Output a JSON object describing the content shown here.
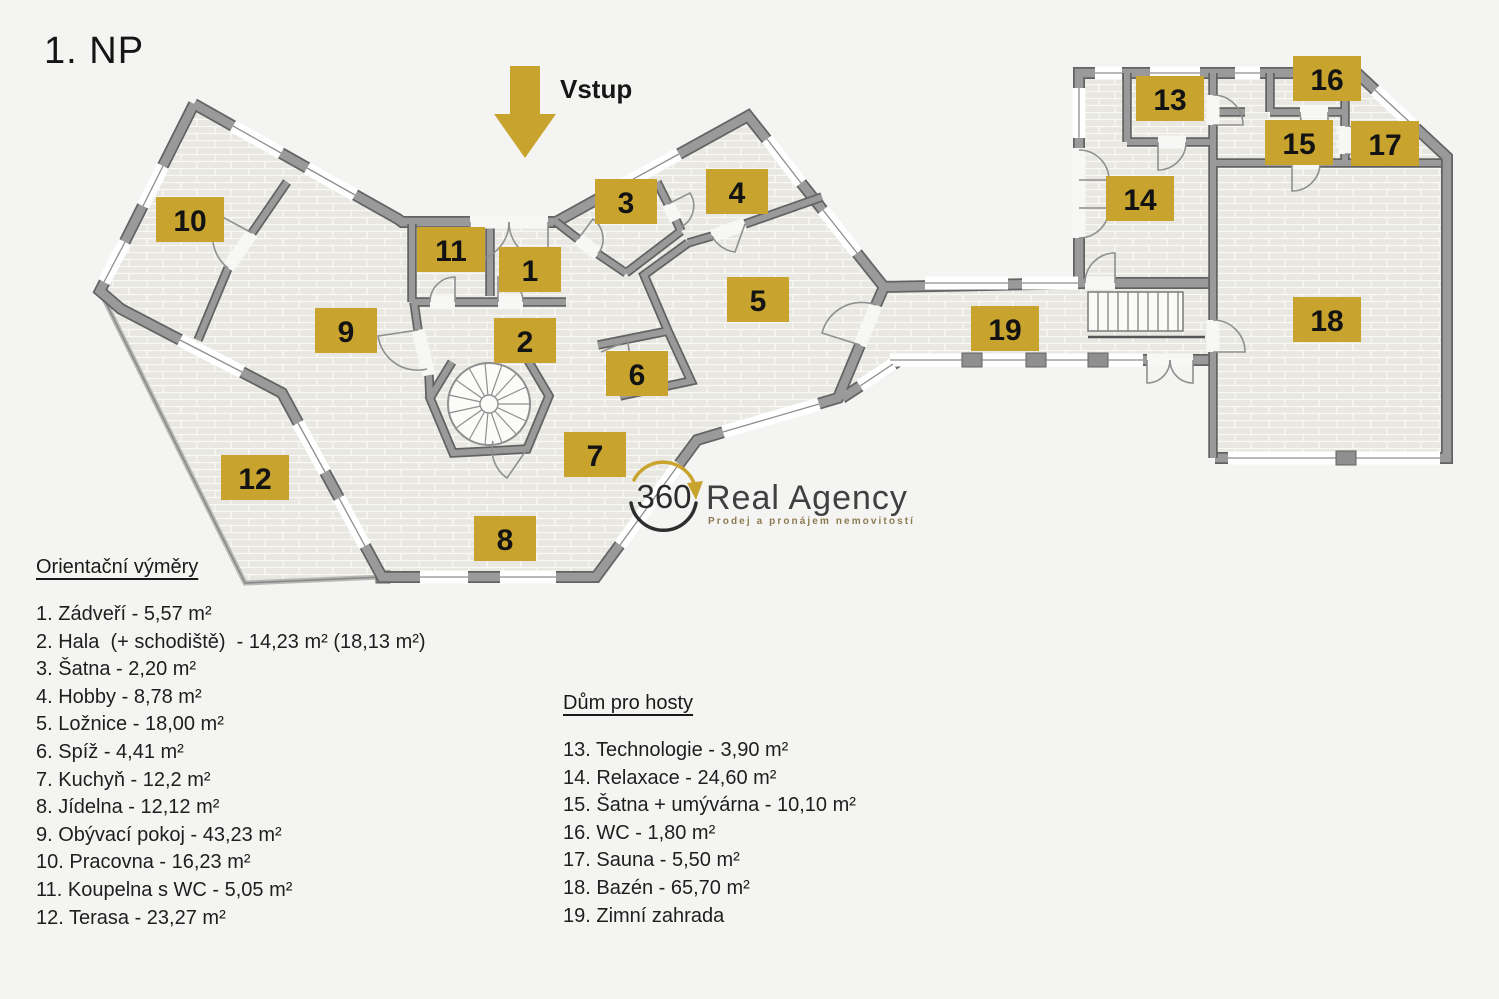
{
  "page": {
    "title": "1. NP",
    "background": "#f4f4f2"
  },
  "entrance": {
    "label": "Vstup"
  },
  "logo": {
    "badge": "360",
    "name": "Real Agency",
    "tagline": "Prodej a pronájem nemovitostí"
  },
  "plan": {
    "badges": [
      "1",
      "2",
      "3",
      "4",
      "5",
      "6",
      "7",
      "8",
      "9",
      "10",
      "11",
      "12",
      "13",
      "14",
      "15",
      "16",
      "17",
      "18",
      "19"
    ]
  },
  "legend_main": {
    "heading": "Orientační výměry",
    "items": [
      "1. Zádveří - 5,57 m²",
      "2. Hala  (+ schodiště)  - 14,23 m² (18,13 m²)",
      "3. Šatna - 2,20 m²",
      "4. Hobby - 8,78 m²",
      "5. Ložnice - 18,00 m²",
      "6. Spíž - 4,41 m²",
      "7. Kuchyň - 12,2 m²",
      "8. Jídelna - 12,12 m²",
      "9. Obývací pokoj - 43,23 m²",
      "10. Pracovna - 16,23 m²",
      "11. Koupelna s WC - 5,05 m²",
      "12. Terasa - 23,27 m²"
    ]
  },
  "legend_guest": {
    "heading": "Dům pro hosty",
    "items": [
      "13. Technologie - 3,90 m²",
      "14. Relaxace - 24,60 m²",
      "15. Šatna + umývárna - 10,10 m²",
      "16. WC - 1,80 m²",
      "17. Sauna - 5,50 m²",
      "18. Bazén - 65,70 m²",
      "19. Zimní zahrada"
    ]
  },
  "colors": {
    "badge_gold": "#c8a42f",
    "wall_gray": "#9a9a9a",
    "wall_dark": "#636363",
    "floor": "#e8e7e2",
    "background": "#f4f4f2",
    "text": "#1c1c1c"
  }
}
